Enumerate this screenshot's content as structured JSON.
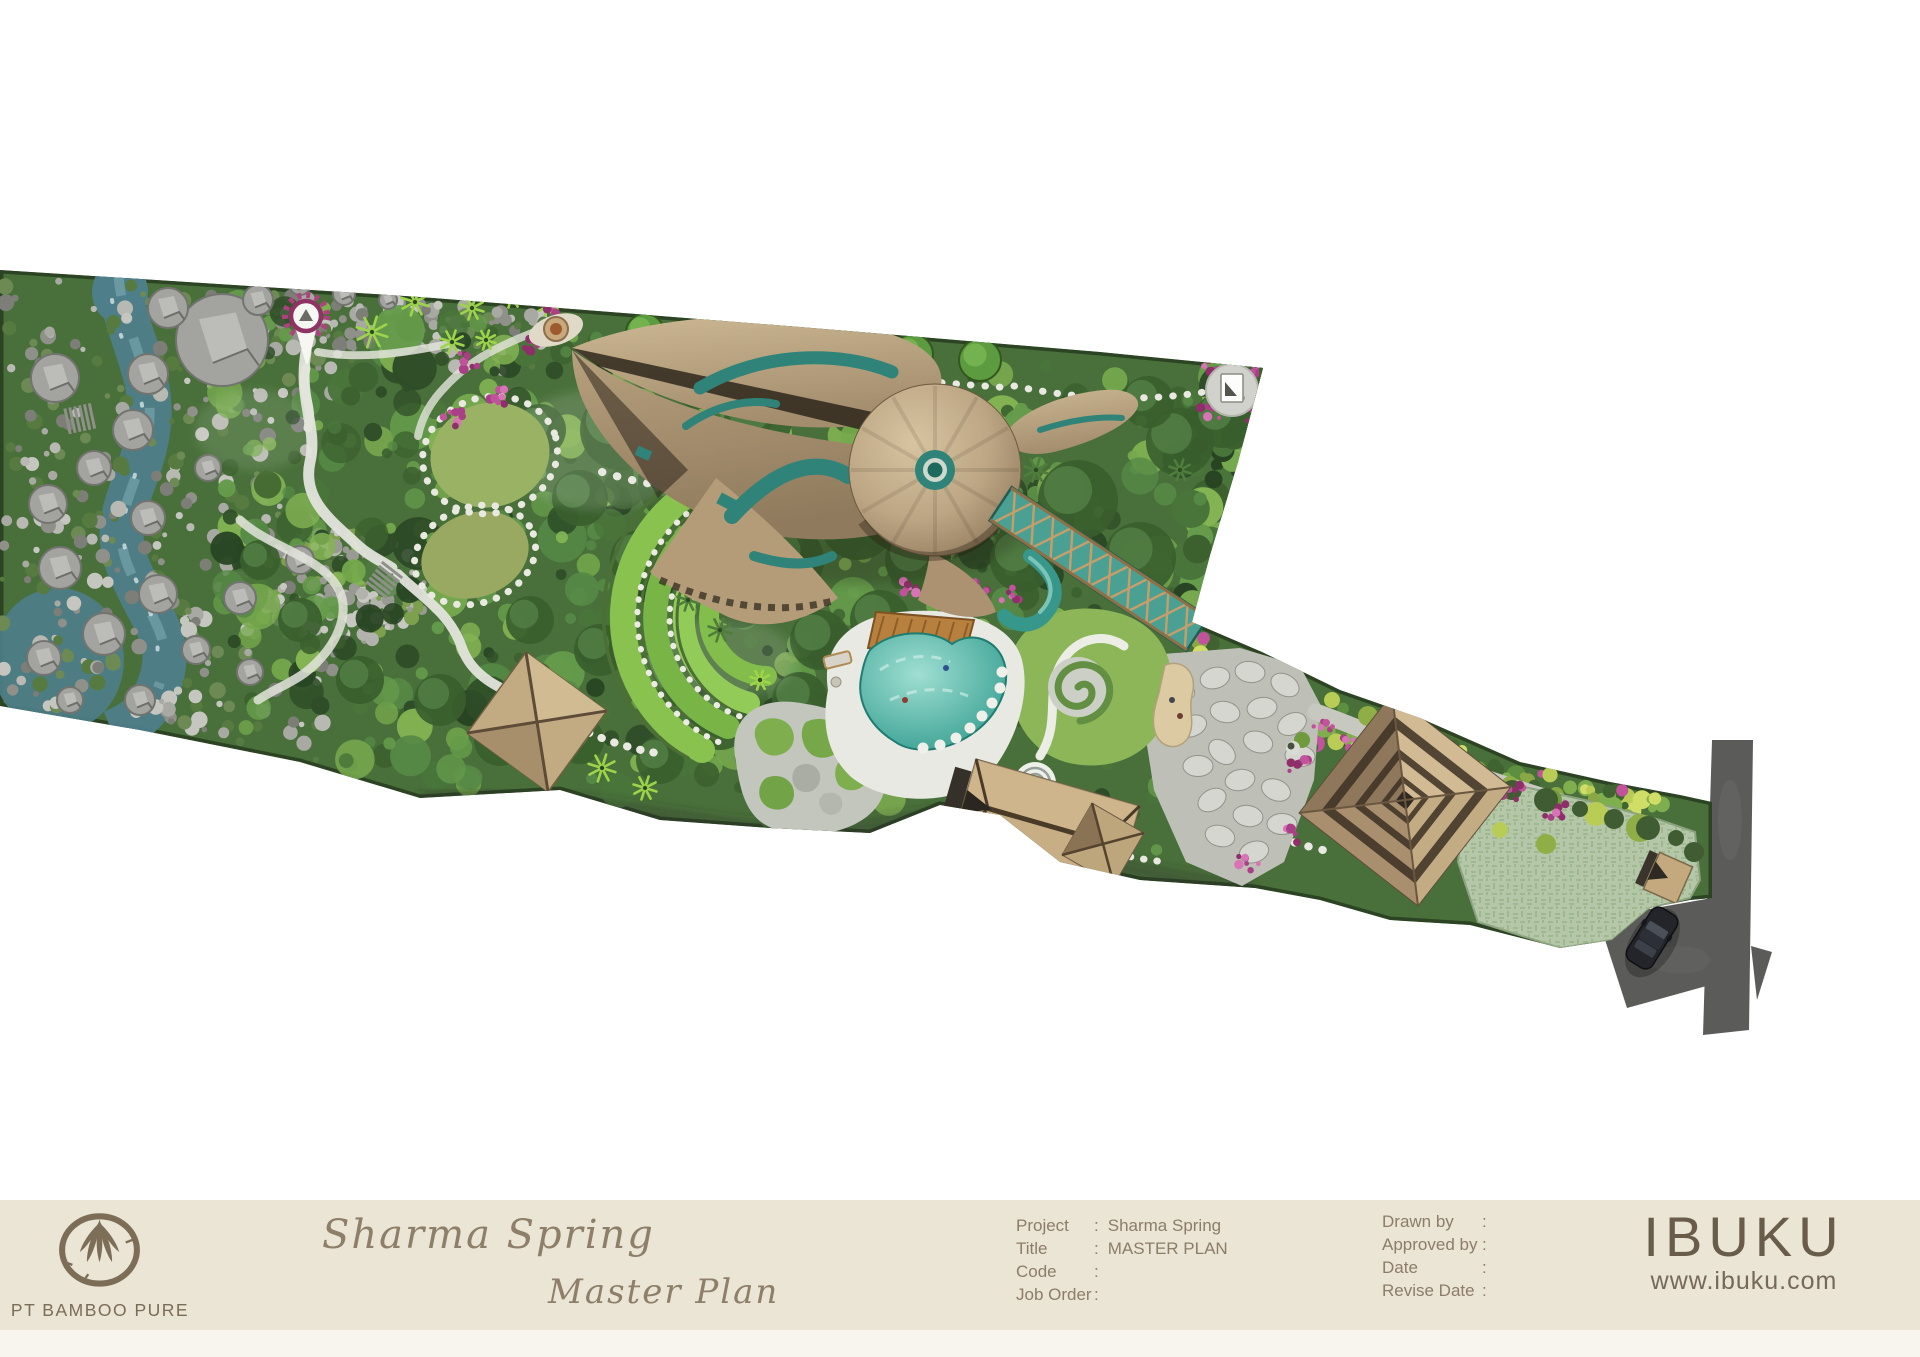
{
  "document": {
    "background": "#ffffff"
  },
  "footer": {
    "background": "#ebe5d5",
    "company": {
      "logo": "bamboo-circle-logo",
      "name": "PT BAMBOO PURE"
    },
    "titles": {
      "project_script": "Sharma Spring",
      "sheet_script": "Master Plan"
    },
    "project_info": {
      "rows": [
        {
          "label": "Project",
          "colon": ":",
          "value": "Sharma Spring"
        },
        {
          "label": "Title",
          "colon": ":",
          "value": "MASTER PLAN"
        },
        {
          "label": "Code",
          "colon": ":",
          "value": ""
        },
        {
          "label": "Job Order",
          "colon": ":",
          "value": ""
        }
      ]
    },
    "approval_info": {
      "rows": [
        {
          "label": "Drawn by",
          "colon": ":",
          "value": ""
        },
        {
          "label": "Approved by",
          "colon": ":",
          "value": ""
        },
        {
          "label": "Date",
          "colon": ":",
          "value": ""
        },
        {
          "label": "Revise Date",
          "colon": ":",
          "value": ""
        }
      ]
    },
    "brand": {
      "name": "IBUKU",
      "website": "www.ibuku.com"
    }
  },
  "plan": {
    "description": "Aerial master-plan rendering of the Sharma Spring site: a long diagonal riverside property with a bamboo leaf-roofed main house, jungle gardens, rice terraces, pools, pavilions and road access at the east end.",
    "features": [
      "river-with-boulders",
      "stone-riverbank",
      "jungle-canopy",
      "location-pin-marker",
      "site-note-marker",
      "garden-paths",
      "leaf-roof-main-house",
      "round-tree-row",
      "fire-pit",
      "lawn-clearings",
      "rice-terraces",
      "terrace-pavilion",
      "moss-rock-garden",
      "swimming-pool",
      "pool-deck",
      "bamboo-bridge",
      "water-slide",
      "spiral-hedge",
      "stone-plaza",
      "flower-beds",
      "pyramid-roof-building",
      "gable-roof-pavilion",
      "grass-paver-courtyard",
      "gate-pavilion",
      "access-road",
      "parked-car"
    ],
    "colors": {
      "water": "#4e7e89",
      "canopy": "#49703a",
      "canopy_dark": "#35552c",
      "canopy_bright": "#79ab48",
      "roof_tan": "#b49c7c",
      "roof_shadow": "#5f4f3d",
      "teal_accent": "#2f8378",
      "pool": "#3aa395",
      "deck": "#e9e9e3",
      "lawn": "#9ab264",
      "terrace_green": "#7ec14e",
      "stone": "#bebfb7",
      "road": "#5b5b59",
      "flower_pink": "#bf4f98",
      "courtyard": "#b5c7a9"
    }
  }
}
